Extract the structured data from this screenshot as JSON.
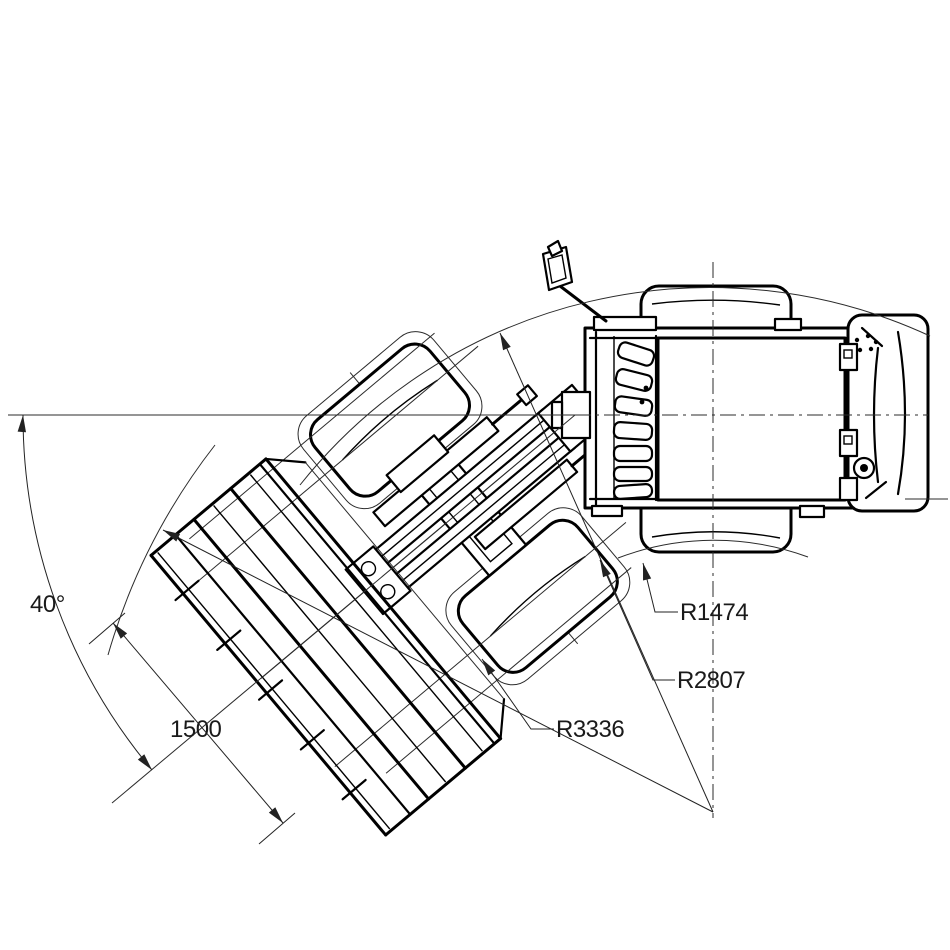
{
  "drawing": {
    "background": "#ffffff",
    "line_color": "#000000",
    "dimension_color": "#1a1a1a",
    "labels": {
      "steer_angle": "40°",
      "offset_1500": "1500",
      "r_inner": "R1474",
      "r_mid": "R2807",
      "r_outer": "R3336"
    }
  }
}
